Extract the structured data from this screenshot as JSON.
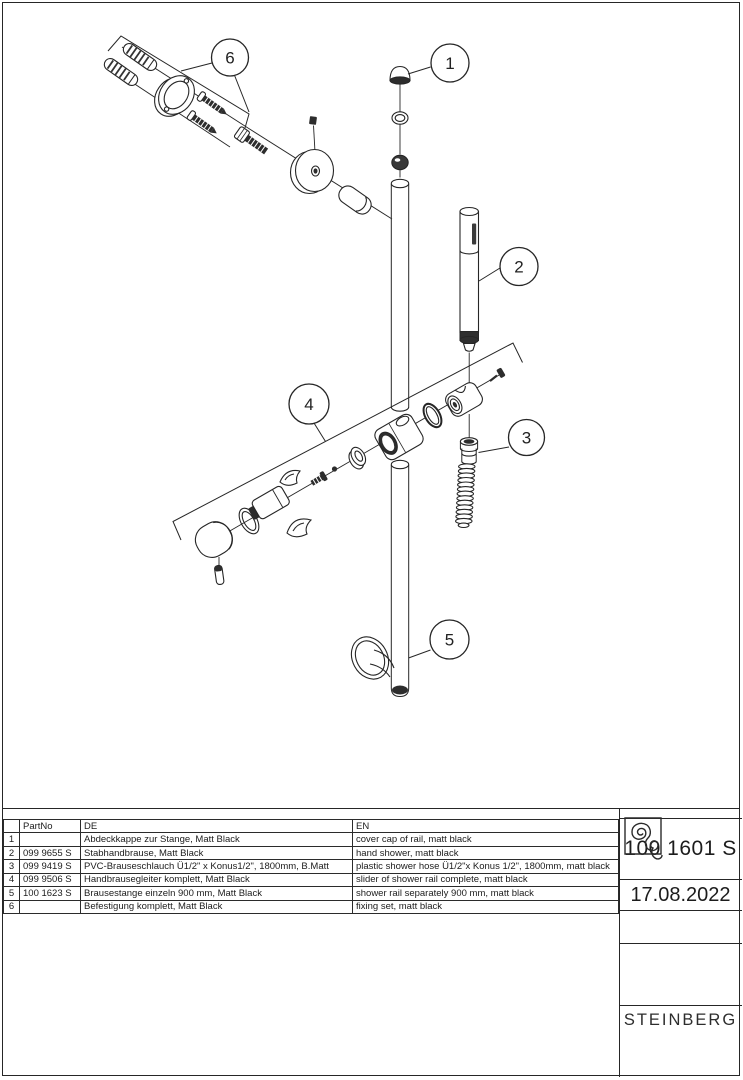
{
  "drawing": {
    "callouts": [
      "1",
      "2",
      "3",
      "4",
      "5",
      "6"
    ]
  },
  "parts_table": {
    "headers": {
      "no": "",
      "part_no": "PartNo",
      "de": "DE",
      "en": "EN"
    },
    "rows": [
      {
        "no": "1",
        "part_no": "",
        "de": "Abdeckkappe zur Stange, Matt Black",
        "en": "cover cap of rail, matt black"
      },
      {
        "no": "2",
        "part_no": "099 9655 S",
        "de": "Stabhandbrause, Matt Black",
        "en": "hand shower, matt black"
      },
      {
        "no": "3",
        "part_no": "099 9419 S",
        "de": "PVC-Brauseschlauch Ü1/2\" x Konus1/2\", 1800mm, B.Matt",
        "en": "plastic shower hose Ü1/2\"x Konus 1/2\", 1800mm, matt black"
      },
      {
        "no": "4",
        "part_no": "099 9506 S",
        "de": "Handbrausegleiter komplett, Matt Black",
        "en": "slider of shower rail complete, matt black"
      },
      {
        "no": "5",
        "part_no": "100 1623 S",
        "de": "Brausestange einzeln 900 mm, Matt Black",
        "en": "shower rail separately 900 mm, matt black"
      },
      {
        "no": "6",
        "part_no": "",
        "de": "Befestigung komplett, Matt Black",
        "en": "fixing set, matt black"
      }
    ]
  },
  "title_block": {
    "part_number": "100 1601 S",
    "date": "17.08.2022",
    "brand": "STEINBERG"
  },
  "colors": {
    "line": "#262626",
    "background": "#ffffff",
    "fill_dark": "#2d2d2d"
  }
}
